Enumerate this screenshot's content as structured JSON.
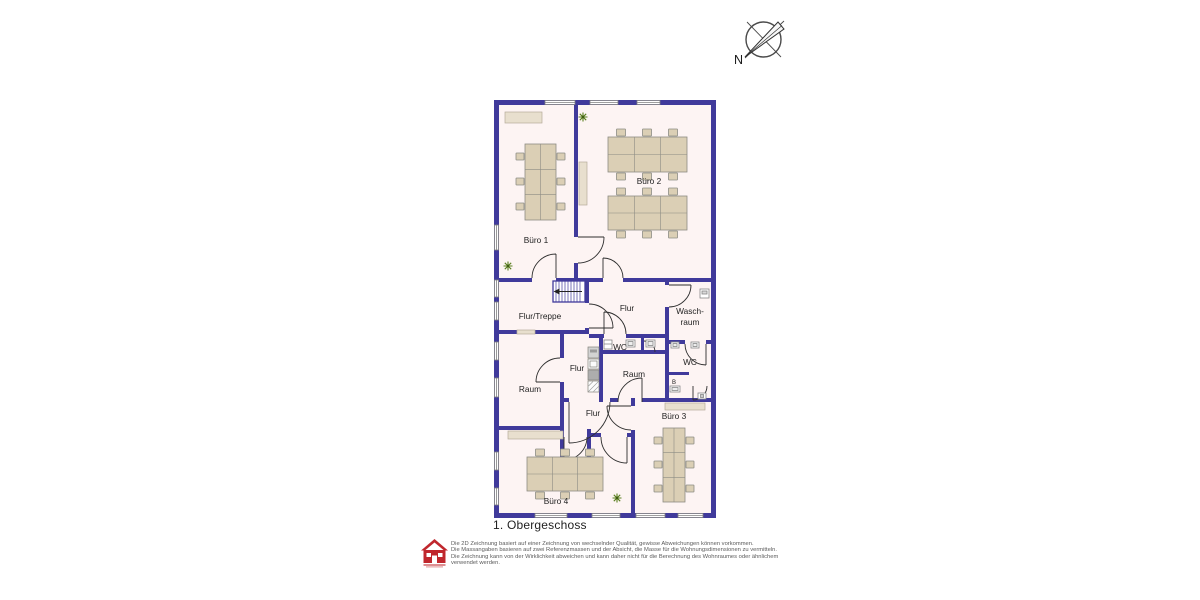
{
  "compass": {
    "north_label": "N"
  },
  "plan": {
    "title": "1. Obergeschoss",
    "rooms": {
      "buero1": "Büro 1",
      "buero2": "Büro 2",
      "flur_treppe": "Flur/Treppe",
      "flur_upper": "Flur",
      "waschraum_line1": "Wasch-",
      "waschraum_line2": "raum",
      "wc_middle": "WC",
      "wc_right": "WC",
      "raum_left": "Raum",
      "raum_middle": "Raum",
      "flur_kitchen": "Flur",
      "flur_lower": "Flur",
      "buero3": "Büro 3",
      "buero4": "Büro 4"
    },
    "fixtures": {
      "boiler_label": "B"
    }
  },
  "footer": {
    "disclaimer_lines": [
      "Die 2D Zeichnung basiert auf einer Zeichnung von wechselnder Qualität, gewisse Abweichungen können vorkommen.",
      "Die Massangaben basieren auf zwei Referenzmassen und der Absicht, die Masse für die Wohnungsdimensionen zu vermitteln.",
      "Die Zeichnung kann von der Wirklichkeit abweichen und kann daher nicht für die Berechnung des Wohnraumes oder ähnlichem",
      "verwendet werden."
    ]
  },
  "colors": {
    "wall": "#403a9b",
    "floor": "#fdf4f3",
    "furniture": "#dbcfb5",
    "cabinet": "#e8dfce",
    "window_frame": "#7f7f7f",
    "plant": "#5a7f1f",
    "logo_red": "#c0272d",
    "text": "#222222"
  }
}
